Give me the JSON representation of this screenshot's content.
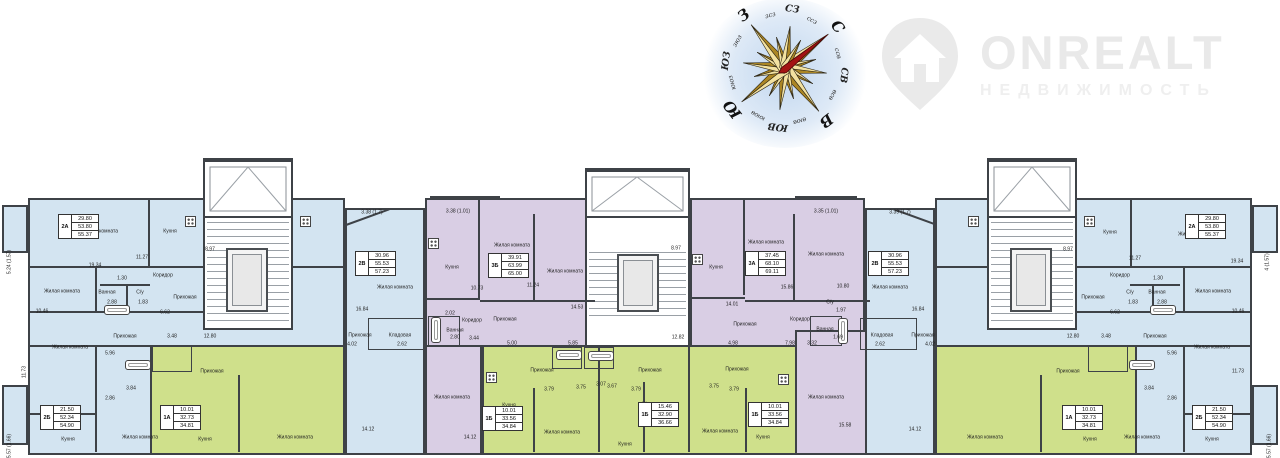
{
  "watermark": {
    "brand": "ONREALT",
    "subtitle": "НЕДВИЖИМОСТЬ"
  },
  "colors": {
    "blue": "#d3e4f1",
    "green": "#cfe08b",
    "purple": "#d9cee4",
    "wall": "#3e4247",
    "needle_red": "#a31313",
    "gold_light": "#f2e1a0",
    "gold_dark": "#ab8624",
    "star_outline": "#2b2413"
  },
  "compass": {
    "rotation_deg": 52,
    "labels": [
      {
        "t": "С",
        "s": "lg"
      },
      {
        "t": "ссв",
        "s": "sm"
      },
      {
        "t": "СВ",
        "s": "md"
      },
      {
        "t": "всв",
        "s": "sm"
      },
      {
        "t": "В",
        "s": "lg"
      },
      {
        "t": "вюв",
        "s": "sm"
      },
      {
        "t": "ЮВ",
        "s": "md"
      },
      {
        "t": "ююв",
        "s": "sm"
      },
      {
        "t": "Ю",
        "s": "lg"
      },
      {
        "t": "ююз",
        "s": "sm"
      },
      {
        "t": "ЮЗ",
        "s": "md"
      },
      {
        "t": "зюз",
        "s": "sm"
      },
      {
        "t": "З",
        "s": "lg"
      },
      {
        "t": "зсз",
        "s": "sm"
      },
      {
        "t": "СЗ",
        "s": "md"
      },
      {
        "t": "ссз",
        "s": "sm"
      }
    ]
  },
  "plan": {
    "tables": [
      {
        "id": "2А",
        "rows": [
          "29.80",
          "53.80",
          "55.37"
        ],
        "x": 58,
        "y": 214
      },
      {
        "id": "2Б",
        "rows": [
          "21.50",
          "52.34",
          "54.90"
        ],
        "x": 40,
        "y": 405
      },
      {
        "id": "1А",
        "rows": [
          "10.01",
          "32.73",
          "34.81"
        ],
        "x": 160,
        "y": 405
      },
      {
        "id": "2В",
        "rows": [
          "30.96",
          "55.53",
          "57.23"
        ],
        "x": 355,
        "y": 251
      },
      {
        "id": "3Б",
        "rows": [
          "39.91",
          "63.99",
          "65.00"
        ],
        "x": 488,
        "y": 253
      },
      {
        "id": "1Б",
        "rows": [
          "10.01",
          "33.56",
          "34.84"
        ],
        "x": 482,
        "y": 406
      },
      {
        "id": "1Б",
        "rows": [
          "15.46",
          "32.90",
          "36.66"
        ],
        "x": 638,
        "y": 402
      },
      {
        "id": "1Б",
        "rows": [
          "10.01",
          "33.56",
          "34.84"
        ],
        "x": 748,
        "y": 402
      },
      {
        "id": "3А",
        "rows": [
          "37.45",
          "68.10",
          "69.11"
        ],
        "x": 745,
        "y": 251
      },
      {
        "id": "2В",
        "rows": [
          "30.96",
          "55.53",
          "57.23"
        ],
        "x": 868,
        "y": 251
      },
      {
        "id": "2А",
        "rows": [
          "29.80",
          "53.80",
          "55.37"
        ],
        "x": 1185,
        "y": 214
      },
      {
        "id": "2Б",
        "rows": [
          "21.50",
          "52.34",
          "54.90"
        ],
        "x": 1192,
        "y": 405
      },
      {
        "id": "1А",
        "rows": [
          "10.01",
          "32.73",
          "34.81"
        ],
        "x": 1062,
        "y": 405
      }
    ],
    "labels": [
      {
        "t": "Кухня",
        "x": 170,
        "y": 232
      },
      {
        "t": "Жилая комната",
        "x": 100,
        "y": 232
      },
      {
        "t": "19.34",
        "x": 95,
        "y": 266
      },
      {
        "t": "11.27",
        "x": 142,
        "y": 258
      },
      {
        "t": "8.97",
        "x": 210,
        "y": 250
      },
      {
        "t": "5.24 (1.57)",
        "x": 10,
        "y": 262,
        "r": -90
      },
      {
        "t": "Коридор",
        "x": 163,
        "y": 276
      },
      {
        "t": "1.30",
        "x": 122,
        "y": 279
      },
      {
        "t": "Прихожая",
        "x": 185,
        "y": 298
      },
      {
        "t": "Ванная",
        "x": 107,
        "y": 293
      },
      {
        "t": "2.88",
        "x": 112,
        "y": 303
      },
      {
        "t": "С/у",
        "x": 140,
        "y": 293
      },
      {
        "t": "1.83",
        "x": 143,
        "y": 303
      },
      {
        "t": "Жилая комната",
        "x": 62,
        "y": 292
      },
      {
        "t": "10.46",
        "x": 42,
        "y": 312
      },
      {
        "t": "6.62",
        "x": 165,
        "y": 313
      },
      {
        "t": "3.48",
        "x": 172,
        "y": 337
      },
      {
        "t": "12.80",
        "x": 210,
        "y": 337
      },
      {
        "t": "Прихожая",
        "x": 125,
        "y": 337
      },
      {
        "t": "Жилая комната",
        "x": 70,
        "y": 348
      },
      {
        "t": "5.96",
        "x": 110,
        "y": 354
      },
      {
        "t": "11.73",
        "x": 25,
        "y": 372,
        "r": -90
      },
      {
        "t": "3.84",
        "x": 131,
        "y": 389
      },
      {
        "t": "2.86",
        "x": 110,
        "y": 399
      },
      {
        "t": "Кухня",
        "x": 68,
        "y": 440
      },
      {
        "t": "Жилая комната",
        "x": 140,
        "y": 438
      },
      {
        "t": "5.57 (1.66)",
        "x": 10,
        "y": 446,
        "r": -90
      },
      {
        "t": "Прихожая",
        "x": 212,
        "y": 372
      },
      {
        "t": "Кухня",
        "x": 205,
        "y": 440
      },
      {
        "t": "Жилая комната",
        "x": 295,
        "y": 438
      },
      {
        "t": "3.38 (1.7)",
        "x": 372,
        "y": 213
      },
      {
        "t": "Жилая комната",
        "x": 395,
        "y": 288
      },
      {
        "t": "16.84",
        "x": 362,
        "y": 310
      },
      {
        "t": "Прихожая",
        "x": 360,
        "y": 336
      },
      {
        "t": "Кладовая",
        "x": 400,
        "y": 336
      },
      {
        "t": "2.62",
        "x": 402,
        "y": 345
      },
      {
        "t": "4.02",
        "x": 352,
        "y": 345
      },
      {
        "t": "14.12",
        "x": 368,
        "y": 430
      },
      {
        "t": "3.38 (1.01)",
        "x": 458,
        "y": 212
      },
      {
        "t": "Кухня",
        "x": 452,
        "y": 268
      },
      {
        "t": "Жилая комната",
        "x": 512,
        "y": 246
      },
      {
        "t": "10.73",
        "x": 477,
        "y": 289
      },
      {
        "t": "11.24",
        "x": 533,
        "y": 286
      },
      {
        "t": "Жилая комната",
        "x": 565,
        "y": 272
      },
      {
        "t": "14.53",
        "x": 577,
        "y": 308
      },
      {
        "t": "Коридор",
        "x": 472,
        "y": 321
      },
      {
        "t": "Прихожая",
        "x": 505,
        "y": 320
      },
      {
        "t": "2.02",
        "x": 450,
        "y": 314
      },
      {
        "t": "Ванная",
        "x": 455,
        "y": 331
      },
      {
        "t": "2.80",
        "x": 455,
        "y": 338
      },
      {
        "t": "3.44",
        "x": 474,
        "y": 339
      },
      {
        "t": "5.00",
        "x": 512,
        "y": 344
      },
      {
        "t": "5.85",
        "x": 573,
        "y": 344
      },
      {
        "t": "Жилая комната",
        "x": 452,
        "y": 398
      },
      {
        "t": "14.12",
        "x": 470,
        "y": 438
      },
      {
        "t": "8.97",
        "x": 676,
        "y": 249
      },
      {
        "t": "12.82",
        "x": 678,
        "y": 338
      },
      {
        "t": "Прихожая",
        "x": 542,
        "y": 371
      },
      {
        "t": "3.79",
        "x": 549,
        "y": 390
      },
      {
        "t": "3.75",
        "x": 581,
        "y": 388
      },
      {
        "t": "3.07",
        "x": 601,
        "y": 385
      },
      {
        "t": "Кухня",
        "x": 509,
        "y": 406
      },
      {
        "t": "Жилая комната",
        "x": 562,
        "y": 433
      },
      {
        "t": "Прихожая",
        "x": 650,
        "y": 371
      },
      {
        "t": "3.67",
        "x": 612,
        "y": 387
      },
      {
        "t": "3.79",
        "x": 636,
        "y": 390
      },
      {
        "t": "Жилая комната",
        "x": 660,
        "y": 405
      },
      {
        "t": "Кухня",
        "x": 625,
        "y": 445
      },
      {
        "t": "Прихожая",
        "x": 737,
        "y": 370
      },
      {
        "t": "3.75",
        "x": 714,
        "y": 387
      },
      {
        "t": "3.79",
        "x": 734,
        "y": 390
      },
      {
        "t": "Жилая комната",
        "x": 720,
        "y": 432
      },
      {
        "t": "Кухня",
        "x": 763,
        "y": 438
      },
      {
        "t": "3.35 (1.01)",
        "x": 826,
        "y": 212
      },
      {
        "t": "Кухня",
        "x": 716,
        "y": 268
      },
      {
        "t": "Жилая комната",
        "x": 766,
        "y": 243
      },
      {
        "t": "Жилая комната",
        "x": 826,
        "y": 255
      },
      {
        "t": "14.01",
        "x": 732,
        "y": 305
      },
      {
        "t": "15.86",
        "x": 787,
        "y": 288
      },
      {
        "t": "10.80",
        "x": 843,
        "y": 287
      },
      {
        "t": "Прихожая",
        "x": 745,
        "y": 325
      },
      {
        "t": "Коридор",
        "x": 800,
        "y": 320
      },
      {
        "t": "С/у",
        "x": 830,
        "y": 303
      },
      {
        "t": "1.97",
        "x": 841,
        "y": 311
      },
      {
        "t": "Ванная",
        "x": 825,
        "y": 330
      },
      {
        "t": "1.69",
        "x": 838,
        "y": 338
      },
      {
        "t": "4.98",
        "x": 733,
        "y": 344
      },
      {
        "t": "7.98",
        "x": 790,
        "y": 344
      },
      {
        "t": "3.32",
        "x": 812,
        "y": 344
      },
      {
        "t": "Жилая комната",
        "x": 826,
        "y": 398
      },
      {
        "t": "15.58",
        "x": 845,
        "y": 426
      },
      {
        "t": "3.39 (1.7)",
        "x": 900,
        "y": 213
      },
      {
        "t": "Жилая комната",
        "x": 890,
        "y": 288
      },
      {
        "t": "16.84",
        "x": 918,
        "y": 310
      },
      {
        "t": "Прихожая",
        "x": 923,
        "y": 336
      },
      {
        "t": "Кладовая",
        "x": 882,
        "y": 336
      },
      {
        "t": "2.62",
        "x": 880,
        "y": 345
      },
      {
        "t": "4.02",
        "x": 930,
        "y": 345
      },
      {
        "t": "14.12",
        "x": 915,
        "y": 430
      },
      {
        "t": "Кухня",
        "x": 1110,
        "y": 233
      },
      {
        "t": "Жилая комната",
        "x": 1196,
        "y": 235
      },
      {
        "t": "11.27",
        "x": 1135,
        "y": 259
      },
      {
        "t": "19.34",
        "x": 1237,
        "y": 262
      },
      {
        "t": "4 (1.57)",
        "x": 1268,
        "y": 262,
        "r": -90
      },
      {
        "t": "8.97",
        "x": 1068,
        "y": 250
      },
      {
        "t": "Коридор",
        "x": 1120,
        "y": 276
      },
      {
        "t": "Прихожая",
        "x": 1093,
        "y": 298
      },
      {
        "t": "С/у",
        "x": 1130,
        "y": 293
      },
      {
        "t": "1.83",
        "x": 1133,
        "y": 303
      },
      {
        "t": "Ванная",
        "x": 1157,
        "y": 293
      },
      {
        "t": "2.88",
        "x": 1162,
        "y": 303
      },
      {
        "t": "Жилая комната",
        "x": 1213,
        "y": 292
      },
      {
        "t": "1.30",
        "x": 1158,
        "y": 279
      },
      {
        "t": "10.46",
        "x": 1238,
        "y": 312
      },
      {
        "t": "6.62",
        "x": 1115,
        "y": 313
      },
      {
        "t": "12.80",
        "x": 1073,
        "y": 337
      },
      {
        "t": "3.48",
        "x": 1106,
        "y": 337
      },
      {
        "t": "Прихожая",
        "x": 1155,
        "y": 337
      },
      {
        "t": "Жилая комната",
        "x": 1212,
        "y": 348
      },
      {
        "t": "5.96",
        "x": 1172,
        "y": 354
      },
      {
        "t": "11.73",
        "x": 1238,
        "y": 372
      },
      {
        "t": "3.84",
        "x": 1149,
        "y": 389
      },
      {
        "t": "2.86",
        "x": 1172,
        "y": 399
      },
      {
        "t": "Кухня",
        "x": 1212,
        "y": 440
      },
      {
        "t": "Жилая комната",
        "x": 1142,
        "y": 438
      },
      {
        "t": "Прихожая",
        "x": 1068,
        "y": 372
      },
      {
        "t": "Кухня",
        "x": 1090,
        "y": 440
      },
      {
        "t": "Жилая комната",
        "x": 985,
        "y": 438
      },
      {
        "t": "5.57 (1.66)",
        "x": 1270,
        "y": 446,
        "r": -90
      }
    ]
  }
}
